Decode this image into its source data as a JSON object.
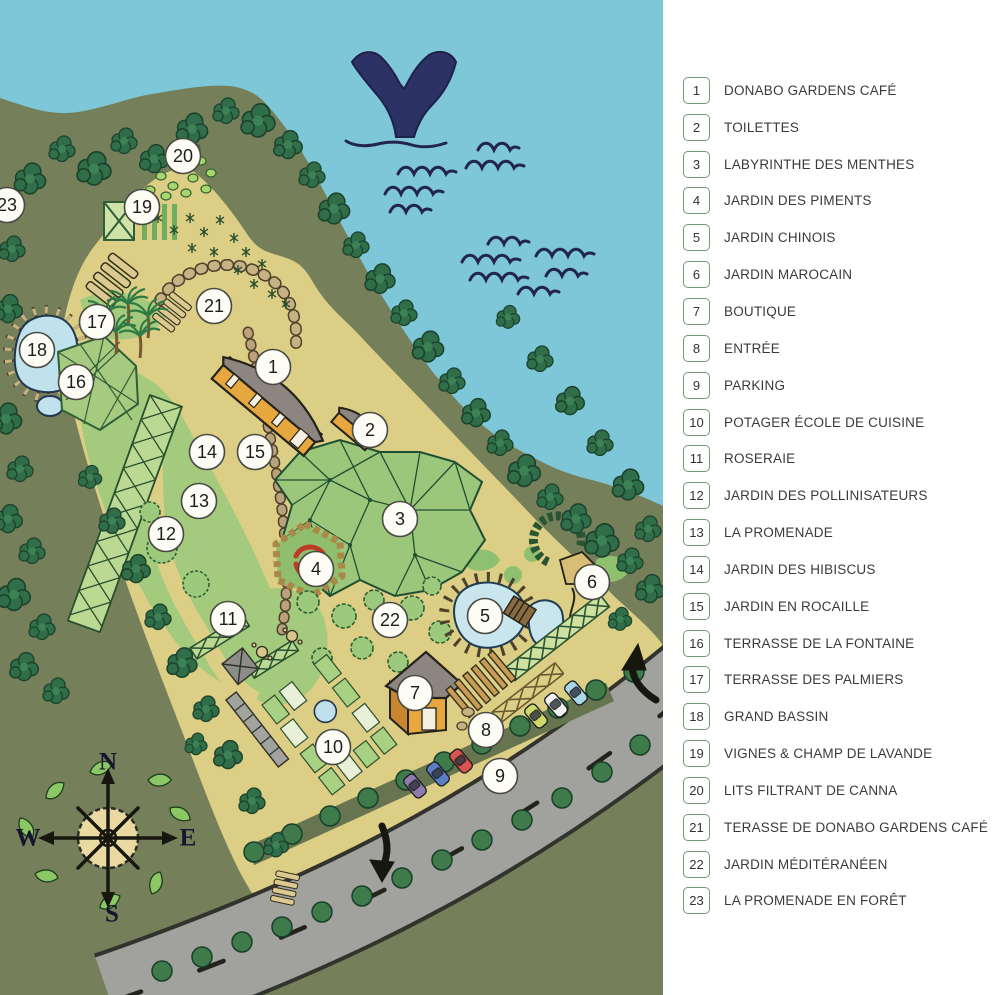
{
  "legend": {
    "items": [
      {
        "n": "1",
        "label": "DONABO GARDENS CAFÉ"
      },
      {
        "n": "2",
        "label": "TOILETTES"
      },
      {
        "n": "3",
        "label": "LABYRINTHE DES MENTHES"
      },
      {
        "n": "4",
        "label": "JARDIN DES PIMENTS"
      },
      {
        "n": "5",
        "label": "JARDIN CHINOIS"
      },
      {
        "n": "6",
        "label": "JARDIN MAROCAIN"
      },
      {
        "n": "7",
        "label": "BOUTIQUE"
      },
      {
        "n": "8",
        "label": "ENTRÉE"
      },
      {
        "n": "9",
        "label": "PARKING"
      },
      {
        "n": "10",
        "label": "POTAGER ÉCOLE DE CUISINE"
      },
      {
        "n": "11",
        "label": "ROSERAIE"
      },
      {
        "n": "12",
        "label": "JARDIN DES POLLINISATEURS"
      },
      {
        "n": "13",
        "label": "LA PROMENADE"
      },
      {
        "n": "14",
        "label": "JARDIN DES HIBISCUS"
      },
      {
        "n": "15",
        "label": "JARDIN EN ROCAILLE"
      },
      {
        "n": "16",
        "label": "TERRASSE DE LA FONTAINE"
      },
      {
        "n": "17",
        "label": "TERRASSE DES PALMIERS"
      },
      {
        "n": "18",
        "label": "GRAND BASSIN"
      },
      {
        "n": "19",
        "label": "VIGNES & CHAMP DE LAVANDE"
      },
      {
        "n": "20",
        "label": "LITS FILTRANT DE CANNA"
      },
      {
        "n": "21",
        "label": "TERASSE DE DONABO GARDENS CAFÉ"
      },
      {
        "n": "22",
        "label": "JARDIN MÉDITÉRANÉEN"
      },
      {
        "n": "23",
        "label": "LA PROMENADE EN FORÊT"
      }
    ]
  },
  "map": {
    "compass": {
      "north": "N",
      "east": "E",
      "south": "S",
      "west": "W"
    },
    "markers": [
      {
        "n": "1",
        "x": 273,
        "y": 367
      },
      {
        "n": "2",
        "x": 370,
        "y": 430
      },
      {
        "n": "3",
        "x": 400,
        "y": 519
      },
      {
        "n": "4",
        "x": 316,
        "y": 569
      },
      {
        "n": "5",
        "x": 485,
        "y": 616
      },
      {
        "n": "6",
        "x": 592,
        "y": 582
      },
      {
        "n": "7",
        "x": 415,
        "y": 693
      },
      {
        "n": "8",
        "x": 486,
        "y": 730
      },
      {
        "n": "9",
        "x": 500,
        "y": 776
      },
      {
        "n": "10",
        "x": 333,
        "y": 747
      },
      {
        "n": "11",
        "x": 228,
        "y": 619
      },
      {
        "n": "12",
        "x": 166,
        "y": 534
      },
      {
        "n": "13",
        "x": 199,
        "y": 501
      },
      {
        "n": "14",
        "x": 207,
        "y": 452
      },
      {
        "n": "15",
        "x": 255,
        "y": 452
      },
      {
        "n": "16",
        "x": 76,
        "y": 382
      },
      {
        "n": "17",
        "x": 97,
        "y": 322
      },
      {
        "n": "18",
        "x": 37,
        "y": 350
      },
      {
        "n": "19",
        "x": 142,
        "y": 207
      },
      {
        "n": "20",
        "x": 183,
        "y": 156
      },
      {
        "n": "21",
        "x": 214,
        "y": 306
      },
      {
        "n": "22",
        "x": 390,
        "y": 620
      },
      {
        "n": "23",
        "x": 7,
        "y": 205
      }
    ],
    "icons": {
      "whale": "whale-tail-icon",
      "waves": "sea-waves-icon",
      "compass": "compass-rose-icon"
    },
    "colors": {
      "water": "#7EC7D8",
      "whale_navy": "#2C3166",
      "forest_green": "#75805A",
      "tree_green": "#2F6E49",
      "ground_tan": "#DCCE85",
      "lawn_green": "#A3CA7D",
      "pond_blue": "#C9E6EE",
      "building_orange": "#E6A73E",
      "roof_gray": "#8D8680",
      "road_gray": "#A1A19D",
      "legend_border_green": "#6F9F72",
      "legend_text": "#3A3A3A",
      "car_colors": [
        "#8F7BB0",
        "#5B7FC4",
        "#D9534F",
        "#CDD96A",
        "#F2F2F2",
        "#A8D8E8"
      ]
    }
  }
}
